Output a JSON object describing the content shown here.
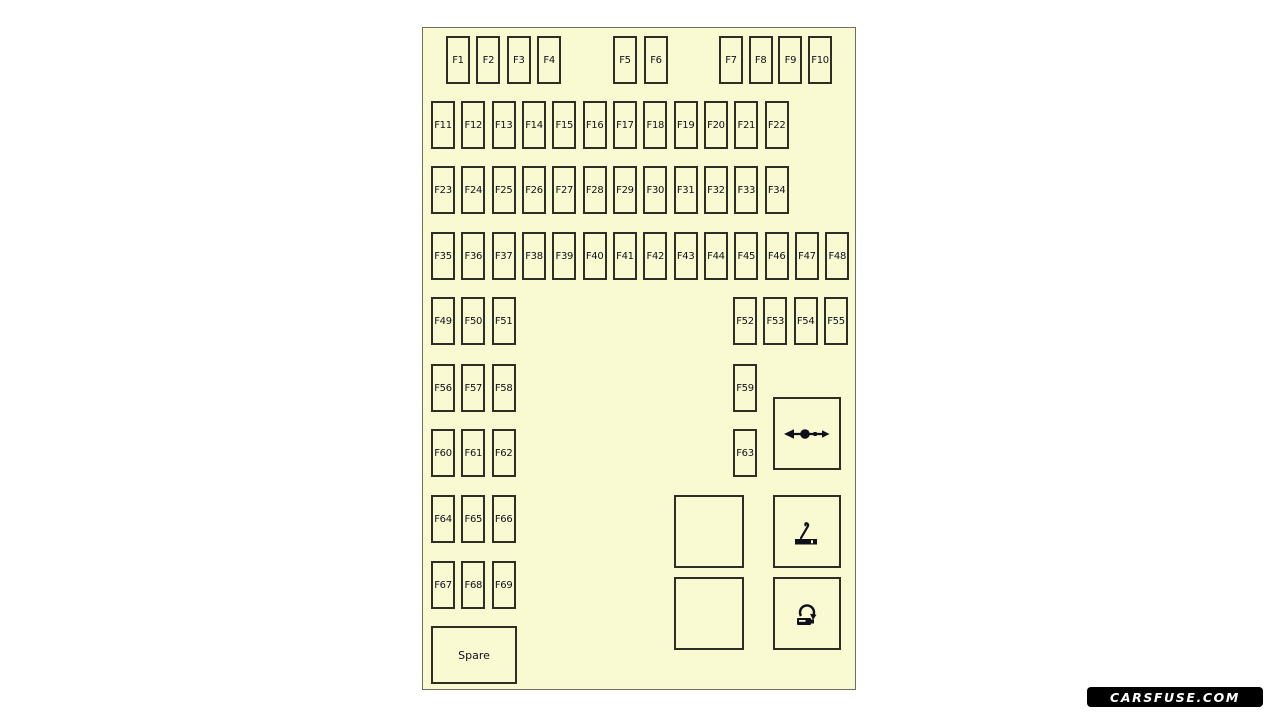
{
  "page": {
    "background": "#ffffff"
  },
  "panel": {
    "fill": "#FAFAD2",
    "border_color": "#6f6f60",
    "fuse_border_color": "#2e2e27",
    "label_color": "#10101a"
  },
  "fuse_size": {
    "width": 24,
    "height": 48
  },
  "fuse_groups": [
    {
      "name": "row1-left",
      "x": 23,
      "y": 8,
      "pitch": 30.4,
      "labels": [
        "F1",
        "F2",
        "F3",
        "F4"
      ]
    },
    {
      "name": "row1-middle",
      "x": 190,
      "y": 8,
      "pitch": 31,
      "labels": [
        "F5",
        "F6"
      ]
    },
    {
      "name": "row1-right",
      "x": 296,
      "y": 8,
      "pitch": 29.7,
      "labels": [
        "F7",
        "F8",
        "F9",
        "F10"
      ]
    },
    {
      "name": "row2",
      "x": 8,
      "y": 73,
      "pitch": 30.33,
      "labels": [
        "F11",
        "F12",
        "F13",
        "F14",
        "F15",
        "F16",
        "F17",
        "F18",
        "F19",
        "F20",
        "F21",
        "F22"
      ]
    },
    {
      "name": "row3",
      "x": 8,
      "y": 138,
      "pitch": 30.33,
      "labels": [
        "F23",
        "F24",
        "F25",
        "F26",
        "F27",
        "F28",
        "F29",
        "F30",
        "F31",
        "F32",
        "F33",
        "F34"
      ]
    },
    {
      "name": "row4",
      "x": 8,
      "y": 204,
      "pitch": 30.33,
      "labels": [
        "F35",
        "F36",
        "F37",
        "F38",
        "F39",
        "F40",
        "F41",
        "F42",
        "F43",
        "F44",
        "F45",
        "F46",
        "F47",
        "F48"
      ]
    },
    {
      "name": "row5-left",
      "x": 8,
      "y": 269,
      "pitch": 30.33,
      "labels": [
        "F49",
        "F50",
        "F51"
      ]
    },
    {
      "name": "row5-right",
      "x": 310,
      "y": 269,
      "pitch": 30.33,
      "labels": [
        "F52",
        "F53",
        "F54",
        "F55"
      ]
    },
    {
      "name": "row6-left",
      "x": 8,
      "y": 336,
      "pitch": 30.33,
      "labels": [
        "F56",
        "F57",
        "F58"
      ]
    },
    {
      "name": "row6-right",
      "x": 310,
      "y": 336,
      "pitch": 30.33,
      "labels": [
        "F59"
      ]
    },
    {
      "name": "row7-left",
      "x": 8,
      "y": 401,
      "pitch": 30.33,
      "labels": [
        "F60",
        "F61",
        "F62"
      ]
    },
    {
      "name": "row7-right",
      "x": 310,
      "y": 401,
      "pitch": 30.33,
      "labels": [
        "F63"
      ]
    },
    {
      "name": "row8",
      "x": 8,
      "y": 467,
      "pitch": 30.33,
      "labels": [
        "F64",
        "F65",
        "F66"
      ]
    },
    {
      "name": "row9",
      "x": 8,
      "y": 533,
      "pitch": 30.33,
      "labels": [
        "F67",
        "F68",
        "F69"
      ]
    }
  ],
  "boxes": {
    "spare": {
      "label": "Spare"
    },
    "empty_count": 2,
    "icons": {
      "top": "axle-double-arrow-icon",
      "middle": "cigarette-lighter-icon",
      "bottom": "power-outlet-plug-icon"
    }
  },
  "watermark": {
    "text": "CARSFUSE.COM",
    "background": "#000000",
    "text_color": "#ffffff"
  }
}
